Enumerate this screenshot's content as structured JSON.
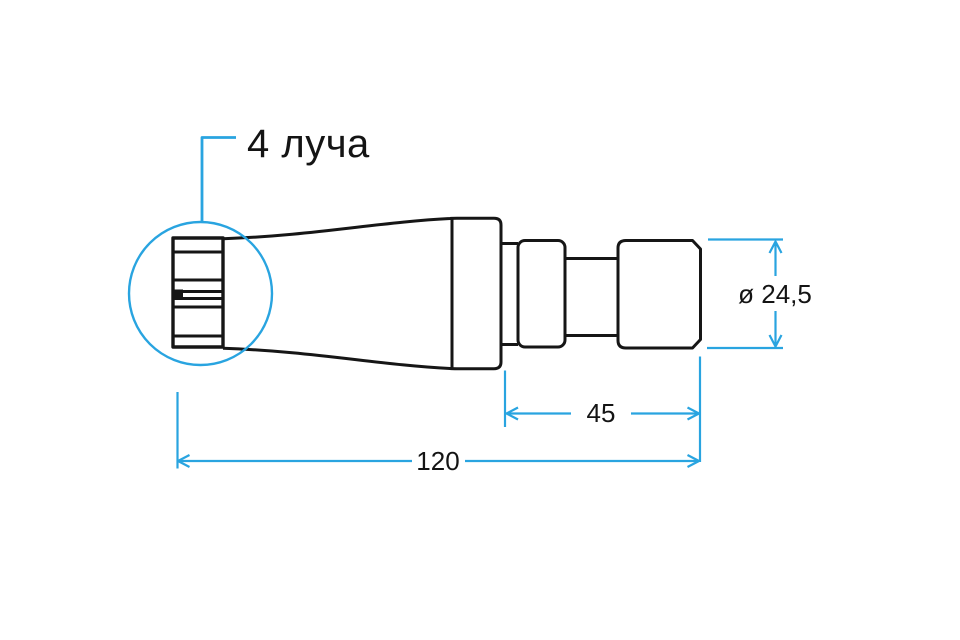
{
  "drawing": {
    "type": "technical-dimension-drawing",
    "callout": {
      "label": "4 луча"
    },
    "dimensions": {
      "diameter": {
        "label": "ø 24,5"
      },
      "head_length": {
        "label": "45"
      },
      "total_length": {
        "label": "120"
      }
    },
    "colors": {
      "line": "#161616",
      "dimension": "#29a4e0",
      "background": "#ffffff"
    }
  }
}
